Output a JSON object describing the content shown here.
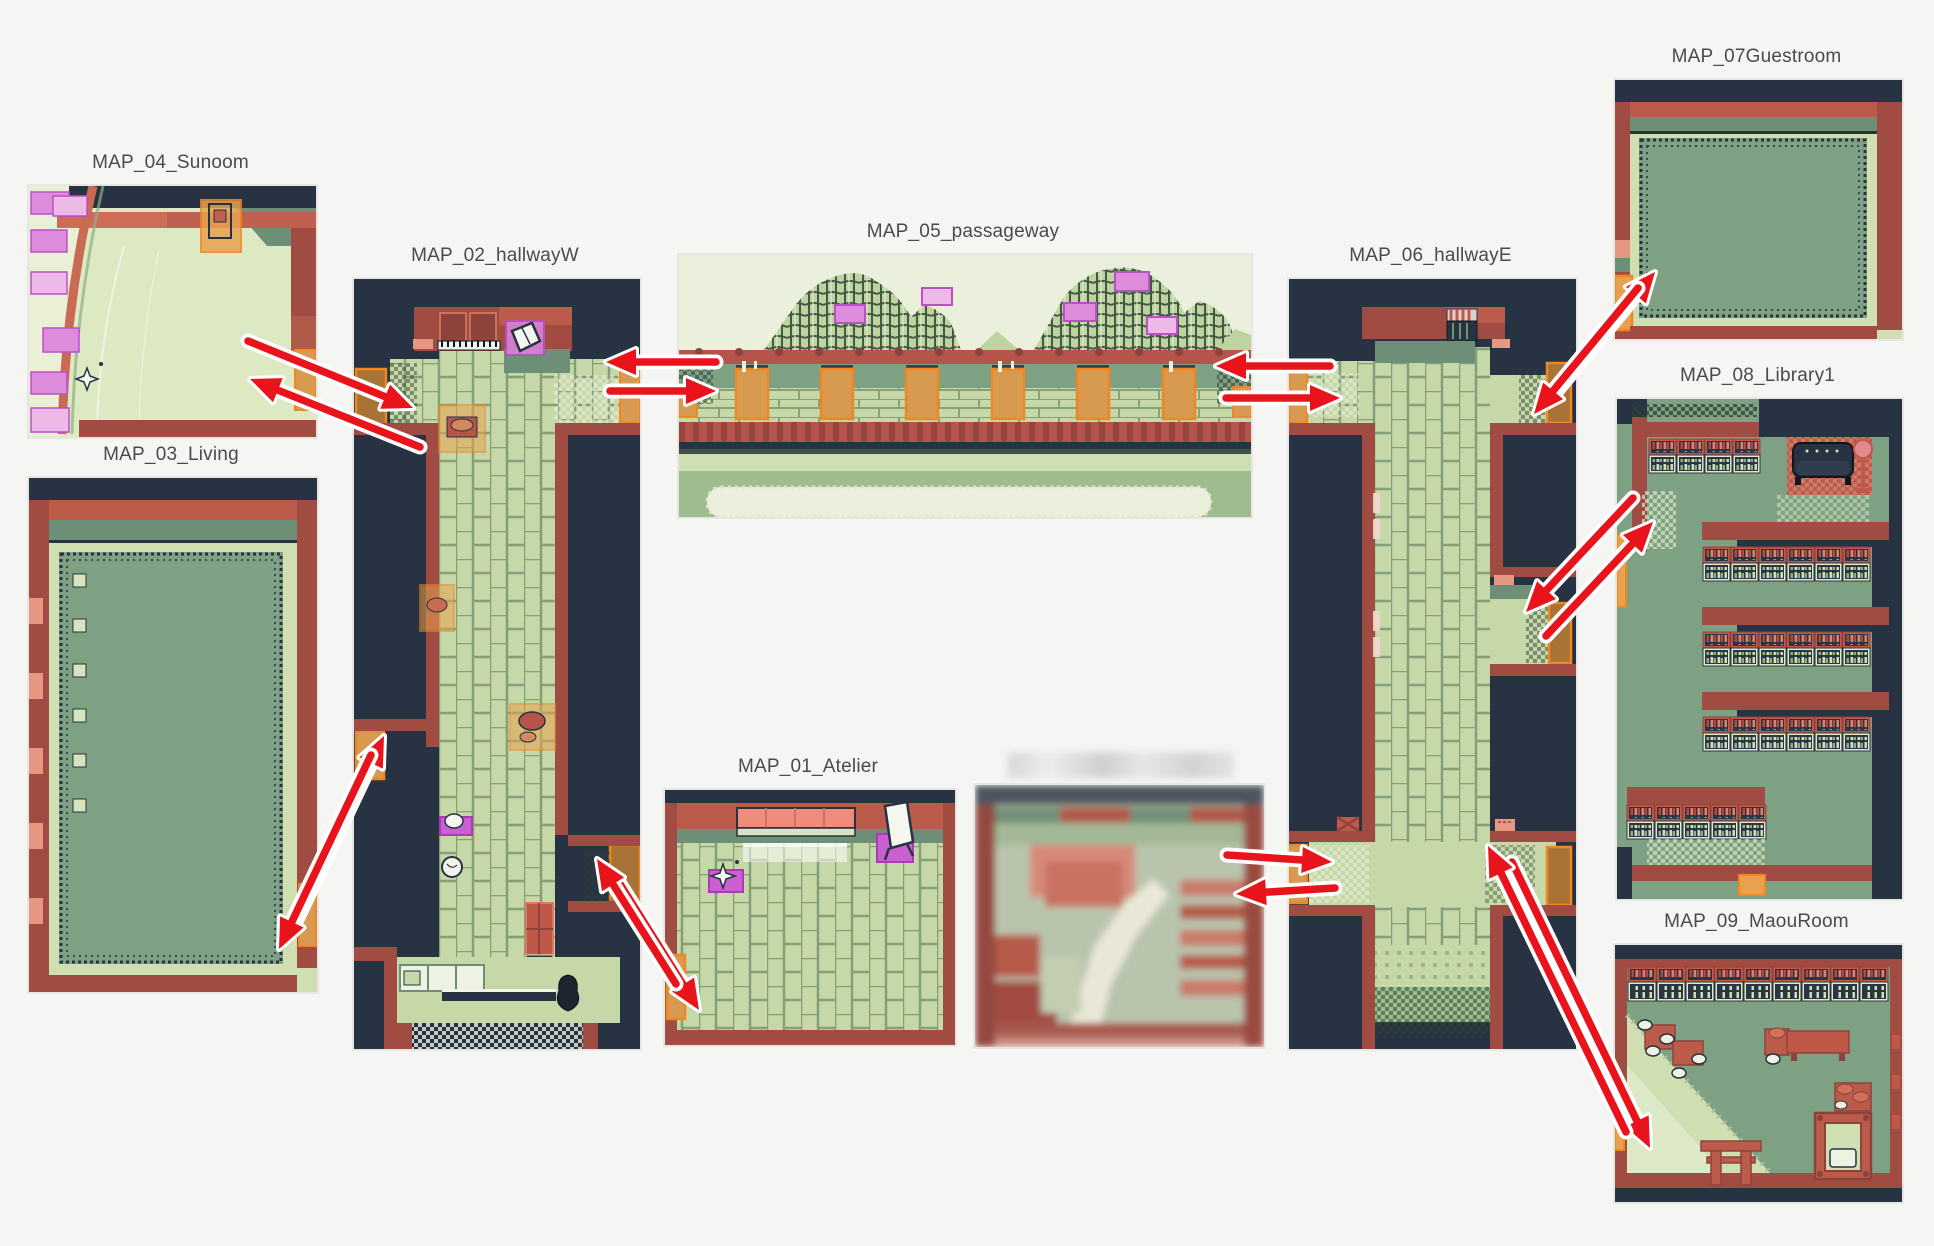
{
  "diagram": {
    "background": "#f5f6f3",
    "label_color": "#4a4a4a",
    "arrow_color": "#e8131b",
    "arrow_outline": "#ffffff",
    "panel_border": "#e6e7e3"
  },
  "maps": [
    {
      "key": "atelier",
      "label": "MAP_01_Atelier"
    },
    {
      "key": "hallwayW",
      "label": "MAP_02_hallwayW"
    },
    {
      "key": "living",
      "label": "MAP_03_Living"
    },
    {
      "key": "sunoom",
      "label": "MAP_04_Sunoom"
    },
    {
      "key": "passageway",
      "label": "MAP_05_passageway"
    },
    {
      "key": "hallwayE",
      "label": "MAP_06_hallwayE"
    },
    {
      "key": "guestroom",
      "label": "MAP_07Guestroom"
    },
    {
      "key": "library1",
      "label": "MAP_08_Library1"
    },
    {
      "key": "maouroom",
      "label": "MAP_09_MaouRoom"
    },
    {
      "key": "censored",
      "label": "",
      "censored": true
    }
  ],
  "connections": [
    {
      "from": "MAP_04_Sunoom",
      "to": "MAP_02_hallwayW",
      "bidirectional": true,
      "arrows": [
        [
          248,
          341,
          413,
          408
        ],
        [
          420,
          447,
          250,
          379
        ]
      ]
    },
    {
      "from": "MAP_02_hallwayW",
      "to": "MAP_05_passageway",
      "bidirectional": true,
      "arrows": [
        [
          716,
          362,
          606,
          362
        ],
        [
          610,
          391,
          716,
          391
        ]
      ]
    },
    {
      "from": "MAP_05_passageway",
      "to": "MAP_06_hallwayE",
      "bidirectional": true,
      "arrows": [
        [
          1330,
          366,
          1216,
          366
        ],
        [
          1226,
          398,
          1340,
          398
        ]
      ]
    },
    {
      "from": "MAP_06_hallwayE",
      "to": "MAP_07Guestroom",
      "bidirectional": true,
      "arrows": [
        [
          1551,
          398,
          1655,
          272
        ],
        [
          1638,
          288,
          1534,
          414
        ]
      ]
    },
    {
      "from": "MAP_06_hallwayE",
      "to": "MAP_08_Library1",
      "bidirectional": true,
      "arrows": [
        [
          1546,
          636,
          1653,
          522
        ],
        [
          1633,
          498,
          1526,
          612
        ]
      ]
    },
    {
      "from": "MAP_06_hallwayE",
      "to": "MAP_09_MaouRoom",
      "bidirectional": true,
      "arrows": [
        [
          1512,
          862,
          1650,
          1148
        ],
        [
          1626,
          1132,
          1488,
          846
        ]
      ]
    },
    {
      "from": "censored",
      "to": "MAP_06_hallwayE",
      "bidirectional": true,
      "arrows": [
        [
          1227,
          855,
          1332,
          862
        ],
        [
          1335,
          888,
          1236,
          894
        ]
      ]
    },
    {
      "from": "MAP_02_hallwayW",
      "to": "MAP_01_Atelier",
      "bidirectional": true,
      "arrows": [
        [
          620,
          884,
          699,
          1010
        ],
        [
          676,
          984,
          597,
          859
        ]
      ]
    },
    {
      "from": "MAP_03_Living",
      "to": "MAP_02_hallwayW",
      "bidirectional": true,
      "arrows": [
        [
          292,
          930,
          384,
          736
        ],
        [
          371,
          755,
          279,
          949
        ]
      ]
    }
  ]
}
